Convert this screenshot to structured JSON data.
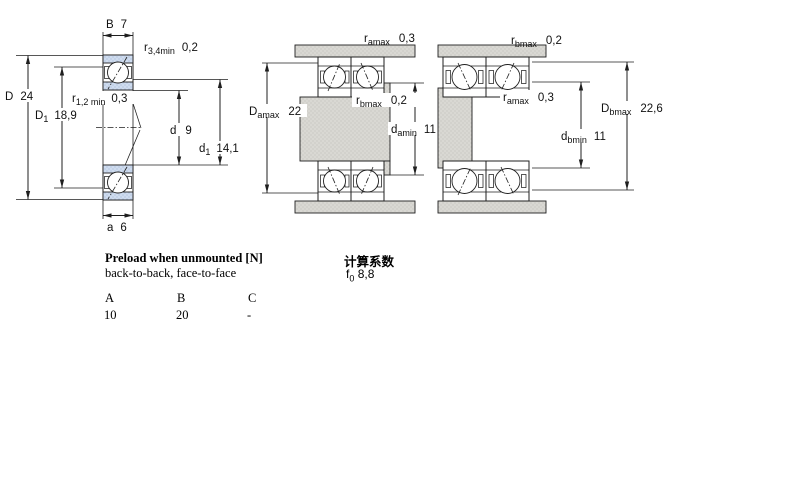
{
  "drawing": {
    "left": {
      "dims": {
        "B": {
          "main": "B",
          "value": "7"
        },
        "r34": {
          "main": "r",
          "sub": "3,4min",
          "value": "0,2"
        },
        "D": {
          "main": "D",
          "value": "24"
        },
        "r12": {
          "main": "r",
          "sub": "1,2 min",
          "value": "0,3"
        },
        "D1": {
          "main": "D",
          "sub": "1",
          "value": "18,9"
        },
        "d": {
          "main": "d",
          "value": "9"
        },
        "d1": {
          "main": "d",
          "sub": "1",
          "value": "14,1"
        },
        "a": {
          "main": "a",
          "value": "6"
        }
      }
    },
    "middle": {
      "dims": {
        "ramax": {
          "main": "r",
          "sub": "amax",
          "value": "0,3"
        },
        "Damax": {
          "main": "D",
          "sub": "amax",
          "value": "22"
        },
        "rbmax": {
          "main": "r",
          "sub": "bmax",
          "value": "0,2"
        },
        "damin": {
          "main": "d",
          "sub": "amin",
          "value": "11"
        }
      }
    },
    "right": {
      "dims": {
        "rbmax": {
          "main": "r",
          "sub": "bmax",
          "value": "0,2"
        },
        "ramax": {
          "main": "r",
          "sub": "amax",
          "value": "0,3"
        },
        "Dbmax": {
          "main": "D",
          "sub": "bmax",
          "value": "22,6"
        },
        "dbmin": {
          "main": "d",
          "sub": "bmin",
          "value": "11"
        }
      }
    },
    "colors": {
      "ring_fill": "#cdd9ec",
      "steel_fill": "#d8d7d2",
      "line": "#1f1f1f"
    }
  },
  "info": {
    "preload_title": "Preload when unmounted [N]",
    "preload_subtitle": "back-to-back, face-to-face",
    "calc_title": "计算系数",
    "f0": {
      "main": "f",
      "sub": "0",
      "value": "8,8"
    },
    "preload_table": {
      "headers": [
        "A",
        "B",
        "C"
      ],
      "values": [
        "10",
        "20",
        "-"
      ]
    }
  }
}
